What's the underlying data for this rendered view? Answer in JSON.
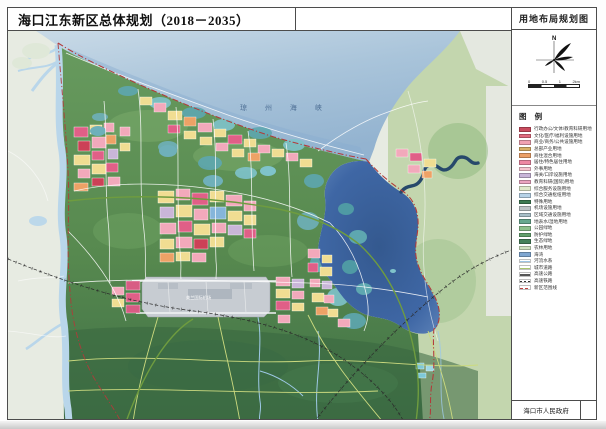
{
  "window": {
    "title": "海口江东新区总体规划（2018－2035）",
    "map_name": "用地布局规划图",
    "publisher": "海口市人民政府"
  },
  "compass": {
    "north_label": "N"
  },
  "scalebar": {
    "labels": [
      "0",
      "0.5",
      "1",
      "2km"
    ]
  },
  "legend": {
    "header": "图 例",
    "items": [
      {
        "label": "行政办公/文体/教育科研用地",
        "color": "#c94b5e",
        "type": "fill"
      },
      {
        "label": "文化/医疗/福利设施用地",
        "color": "#e16a7e",
        "type": "fill"
      },
      {
        "label": "商业/商务/公共设施用地",
        "color": "#f0a2b2",
        "type": "fill"
      },
      {
        "label": "总部产业用地",
        "color": "#d8b168",
        "type": "fill"
      },
      {
        "label": "商住混合用地",
        "color": "#eb9f66",
        "type": "fill"
      },
      {
        "label": "居住/特色居住用地",
        "color": "#ee87a3",
        "type": "fill"
      },
      {
        "label": "外事用地",
        "color": "#f6c3cf",
        "type": "fill"
      },
      {
        "label": "海关/口岸设施用地",
        "color": "#c8b4d8",
        "type": "fill"
      },
      {
        "label": "教育科研(国际)用地",
        "color": "#eaa5c0",
        "type": "fill"
      },
      {
        "label": "综合服务设施用地",
        "color": "#dfe9cb",
        "type": "fill"
      },
      {
        "label": "综合交通枢纽用地",
        "color": "#b6d2e7",
        "type": "fill"
      },
      {
        "label": "特殊用地",
        "color": "#3d7b53",
        "type": "fill"
      },
      {
        "label": "机场设施用地",
        "color": "#bdc4c7",
        "type": "fill"
      },
      {
        "label": "区域交通设施用地",
        "color": "#a8bfc8",
        "type": "fill"
      },
      {
        "label": "地表水/湿地用地",
        "color": "#66a88e",
        "type": "fill"
      },
      {
        "label": "公园绿地",
        "color": "#8dc18c",
        "type": "fill"
      },
      {
        "label": "防护绿地",
        "color": "#62a06c",
        "type": "fill"
      },
      {
        "label": "生态绿地",
        "color": "#44815a",
        "type": "fill"
      },
      {
        "label": "农林用地",
        "color": "#cfe2c0",
        "type": "fill"
      },
      {
        "label": "海湾",
        "color": "#7fa6d1",
        "type": "fill"
      },
      {
        "label": "河流水系",
        "color": "#9cc4e4",
        "type": "line"
      },
      {
        "label": "城市道路",
        "color": "#a9c56e",
        "type": "line"
      },
      {
        "label": "高速公路",
        "color": "#555555",
        "type": "line"
      },
      {
        "label": "高速铁路",
        "color": "#333333",
        "type": "rail"
      },
      {
        "label": "新区范围线",
        "color": "#bf3f3f",
        "type": "dash"
      }
    ]
  },
  "map": {
    "sea_label": "琼 州 海 峡",
    "airport_label": "美兰国际机场",
    "colors": {
      "sea": "#a9c4da",
      "bay": "#3f67a5",
      "land_green": "#5f9357",
      "outside_land": "#e7ebe2",
      "boundary": "#b23a3a"
    }
  }
}
